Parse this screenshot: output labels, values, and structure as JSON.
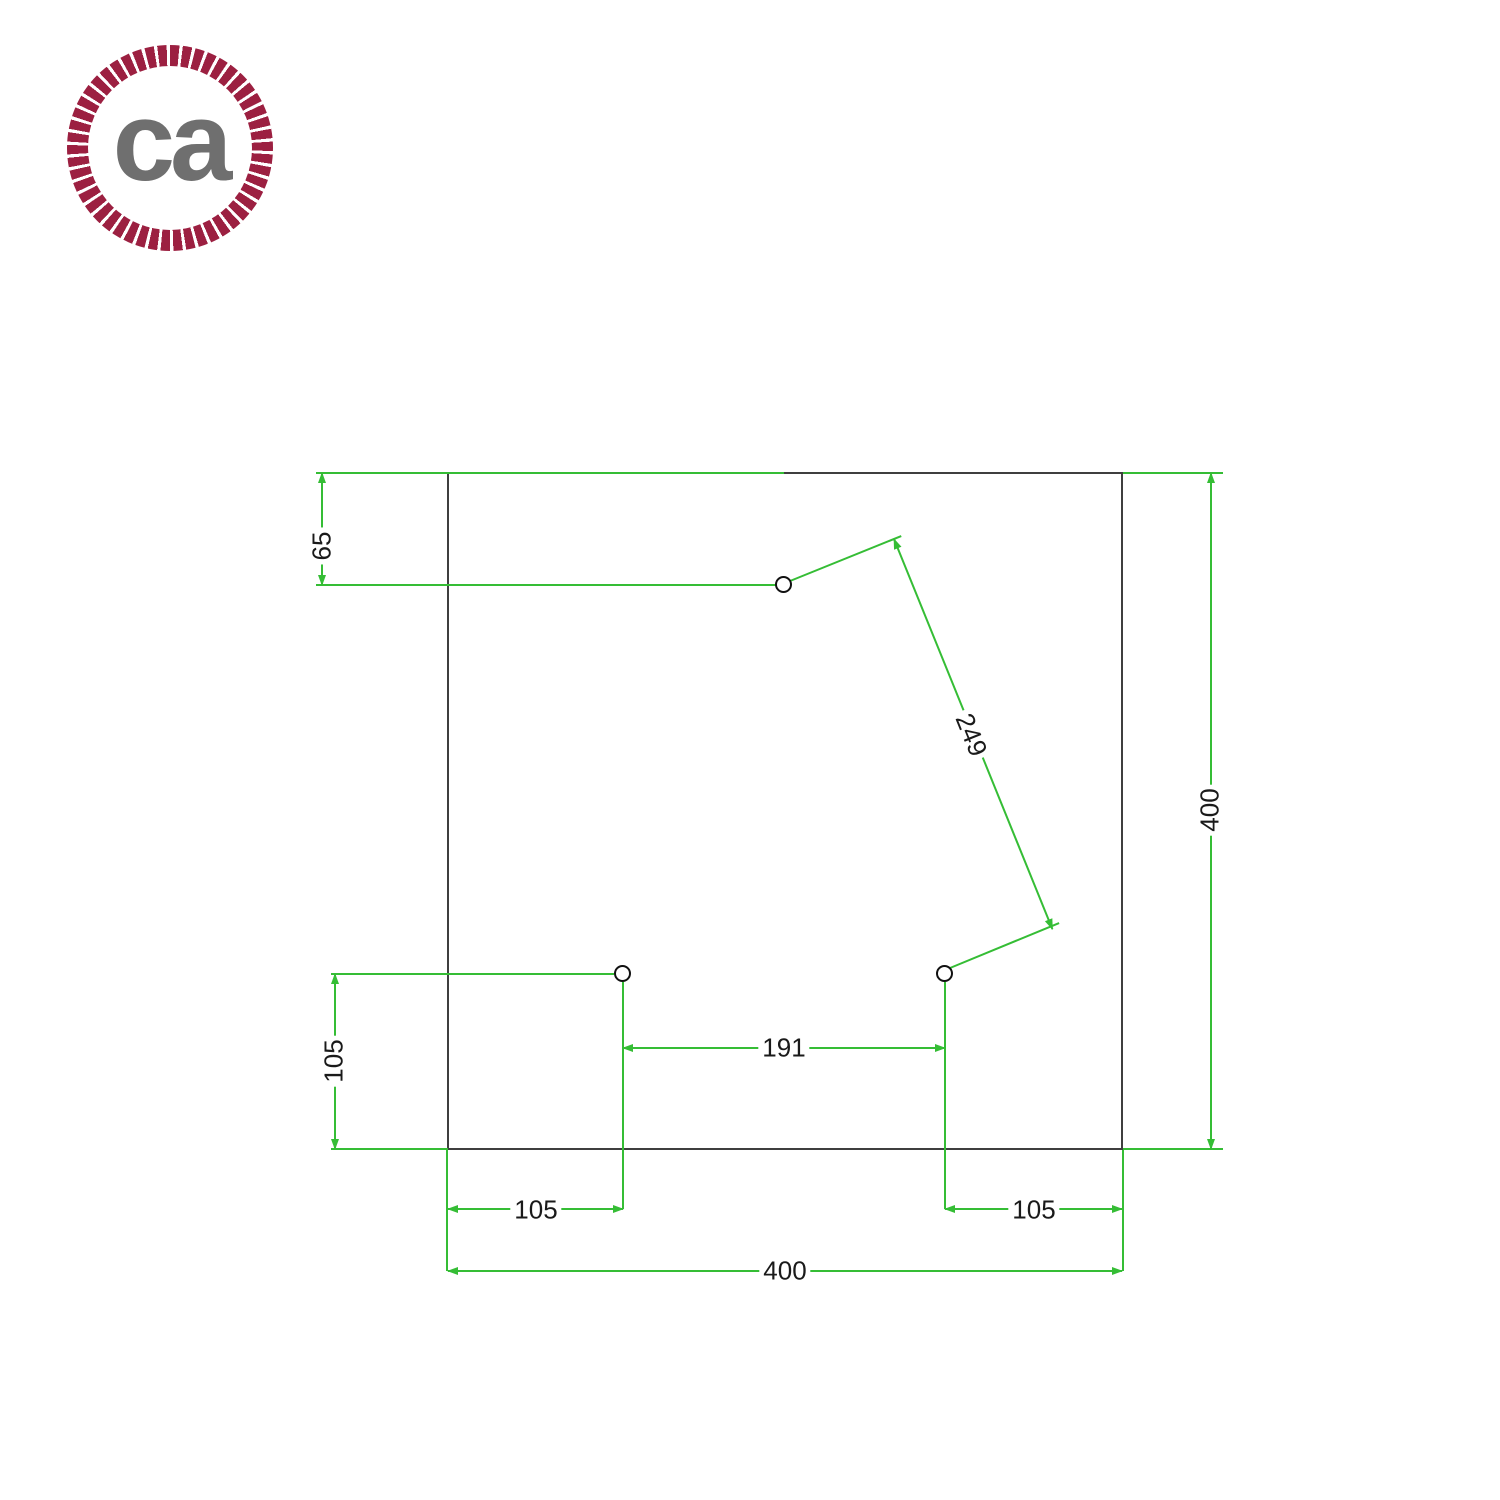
{
  "page": {
    "background_color": "#ffffff"
  },
  "logo": {
    "text": "ca",
    "ring_color": "#9c2041",
    "text_color": "#6f6f6f"
  },
  "drawing": {
    "type": "drilling-template-square-ceiling-rose",
    "outline_color": "#3f3f3f",
    "dimension_color": "#35bd35",
    "label_color": "#1a1a1a",
    "holes_count": 3,
    "dimensions": {
      "hole_top_offset": "65",
      "plate_height": "400",
      "hole_diagonal_distance": "249",
      "hole_bottom_left_vertical_offset": "105",
      "holes_horizontal_spacing": "191",
      "hole_left_edge_offset": "105",
      "hole_right_edge_offset": "105",
      "plate_width": "400"
    }
  }
}
